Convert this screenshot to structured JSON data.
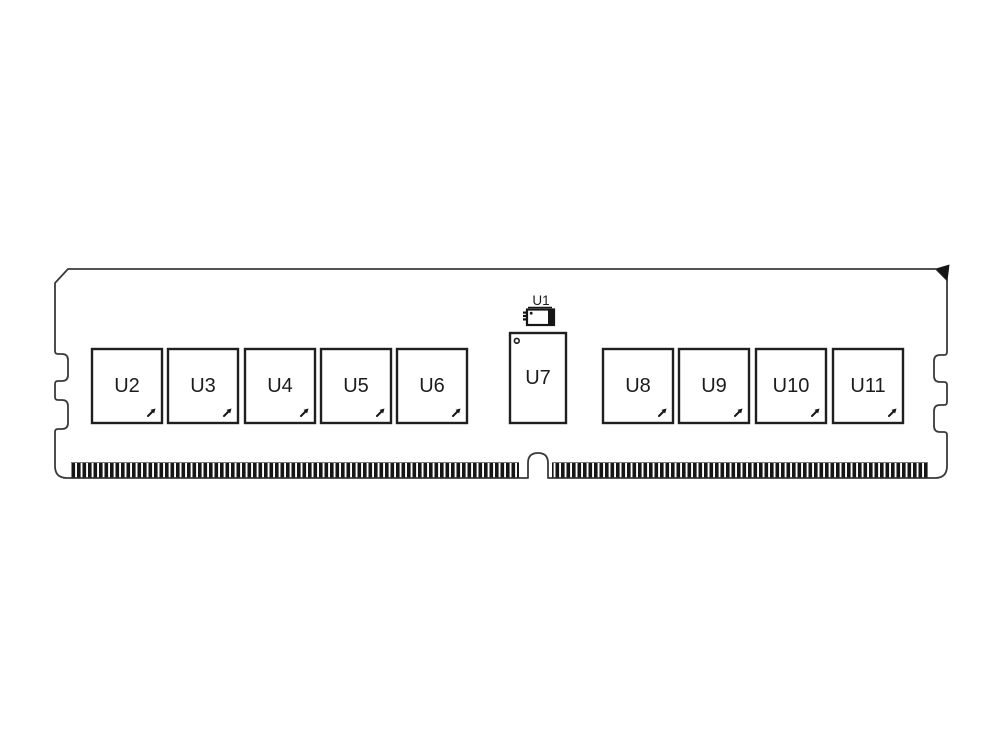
{
  "diagram": {
    "kind": "memory-module-outline-drawing",
    "components": {
      "u1": {
        "label": "U1"
      },
      "chips_left": [
        {
          "label": "U2"
        },
        {
          "label": "U3"
        },
        {
          "label": "U4"
        },
        {
          "label": "U5"
        },
        {
          "label": "U6"
        }
      ],
      "chip_center": {
        "label": "U7"
      },
      "chips_right": [
        {
          "label": "U8"
        },
        {
          "label": "U9"
        },
        {
          "label": "U10"
        },
        {
          "label": "U11"
        }
      ]
    },
    "icons": {
      "pin1_marker": "tiny-diagonal-arrow",
      "pin1_dot": "small-circle",
      "corner_cut": "filled-triangle",
      "edge_fingers": "black-stripe-comb"
    },
    "colors": {
      "background": "#ffffff",
      "outline": "#3a3a3a",
      "chip_border": "#1f1f1f",
      "dark_fill": "#161616",
      "text": "#1c1c1c"
    }
  }
}
